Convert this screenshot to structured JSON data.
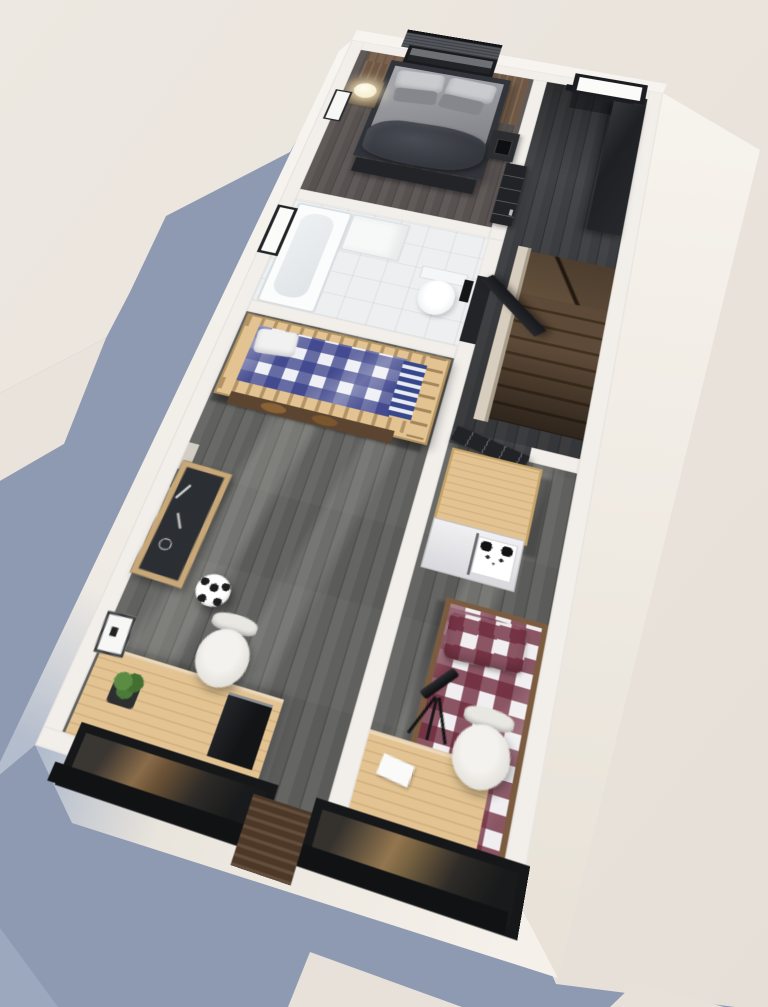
{
  "scene": {
    "title": "3D isometric dollhouse floor-plan render — upper floor",
    "style": "photorealistic cutaway, sunlight from the upper right, blue-grey shadow cast to the lower left",
    "view": "top-down axonometric, plan rotated clockwise"
  },
  "colors": {
    "bg1": "#ede8e1",
    "bg2": "#e6dfd7",
    "shadow": "#8d9ab2",
    "shadow2": "#97a3b8",
    "wallTop": "#f2efeb",
    "faceTop": "#f7f4ef",
    "faceLight": "#f8f5f1",
    "faceMid": "#efebe4",
    "faceBlue": "#b4bdcd",
    "faceRight1": "#f7f3ed",
    "faceRight2": "#e7e1d7",
    "faceBot1": "#aeb9cb",
    "faceBot2": "#e9e4dc",
    "faceBot3": "#f5f1ea",
    "floorMaster": "#575150",
    "floorGrey": "#60615f",
    "floorHall": "#3e4043",
    "bath": "#edeff0",
    "stairWood": "#5e4a38",
    "stairDark": "#41321f",
    "rail": "#d8cebf",
    "woodLight": "#e2c391",
    "woodDark": "#4d3827",
    "headboard": "#7b6350",
    "black": "#212326",
    "blackSoft": "#2c2e32",
    "duvet": "#9fa1a7",
    "pillow": "#c9cbcf",
    "blanket": "#3d3f46",
    "plaidBlue": "#383f88",
    "plaidRed": "#6e2a3c",
    "white": "#f7f7f6",
    "lamp": "#fff3cf",
    "plant": "#4c7a38",
    "glass": "#fbfbfa",
    "panda": "#ffffff"
  },
  "rooms": [
    {
      "id": "master-bedroom",
      "label": "Master bedroom",
      "floor": "dark wood planks",
      "furniture": [
        "double bed with grey bedding",
        "dark crumpled throw",
        "four pillows",
        "wood headboard panels",
        "window with roller blind",
        "glowing sphere lamp",
        "wood nightstand",
        "black nightstand with phone",
        "foot bench",
        "wall picture frame",
        "black interior door"
      ]
    },
    {
      "id": "hallway",
      "label": "Hallway / stair landing",
      "floor": "dark grey wood",
      "furniture": [
        "black framed window",
        "long black wardrobe",
        "beige handrail",
        "winder staircase going down"
      ]
    },
    {
      "id": "bathroom",
      "label": "Bathroom",
      "floor": "white tile",
      "furniture": [
        "bathtub",
        "washbasin unit",
        "wall-hung toilet",
        "black flush plate",
        "side window",
        "open black door"
      ]
    },
    {
      "id": "kids-room-bunk",
      "label": "Kids room (bunk bed)",
      "floor": "grey wood planks",
      "furniture": [
        "wooden bunk bed",
        "blue gingham duvet",
        "white pillow",
        "striped blanket",
        "lower bunk",
        "chalkboard",
        "soccer ball",
        "desk",
        "white shell chair",
        "computer",
        "potted plant",
        "leaning picture frame"
      ]
    },
    {
      "id": "kids-room-plaid",
      "label": "Kids room (plaid bed)",
      "floor": "grey wood planks",
      "furniture": [
        "black door",
        "wardrobe with panda sticker",
        "maroon gingham bed",
        "desk",
        "telescope on tripod",
        "white shell chair",
        "paper sheet"
      ]
    }
  ],
  "exterior": {
    "windows": [
      "bedroom blind window (top)",
      "hall window (top right)",
      "bathroom window (left)",
      "two street windows with black sills (bottom)"
    ],
    "panel": "dark wood spandrel panel between street windows"
  }
}
